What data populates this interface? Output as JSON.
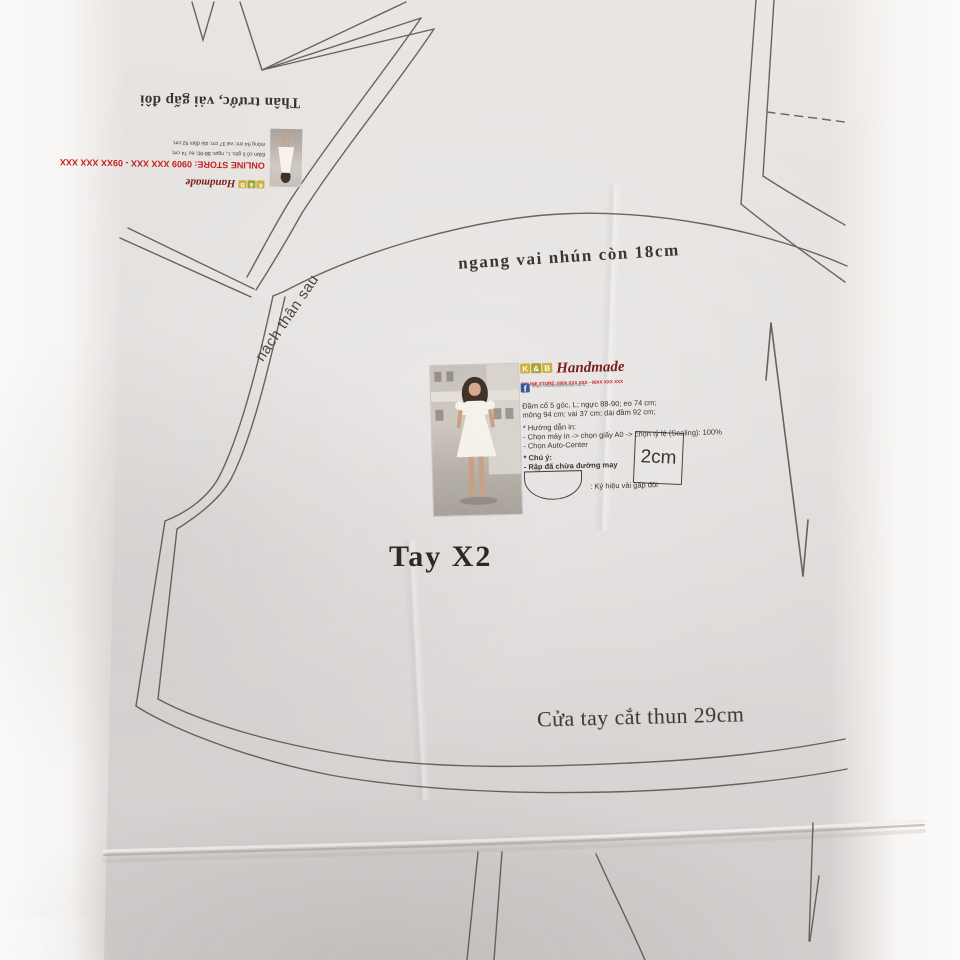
{
  "labels": {
    "shoulder_curve": "ngang vai nhún còn 18cm",
    "back_armhole": "nách thân sau",
    "piece_name": "Tay X2",
    "hem": "Cửa tay cắt thun 29cm",
    "upper_piece": "Thân trước, vải gấp đôi",
    "scale_box": "2cm"
  },
  "info_block": {
    "brand_k": "K",
    "brand_amp": "&",
    "brand_b": "B",
    "brand_name": "Handmade",
    "store_line": "ONLINE STORE: 0909 XXX XXX - 09XX XXX XXX",
    "facebook_f": "f",
    "fb_url": "https://www.facebook.com/…",
    "desc_line1": "Đầm cổ 5 góc, L; ngực 88-90; eo 74 cm;",
    "desc_line2": "mông 94 cm; vai 37 cm; dài đầm 92 cm;",
    "print_title": "* Hướng dẫn in:",
    "print_step1": "- Chọn máy in -> chọn giấy A0 -> chọn tỷ lệ (Scaling): 100%",
    "print_step2": "- Chọn Auto-Center",
    "note_title": "* Chú ý:",
    "note_line": "- Rập đã chừa đường may",
    "fold_symbol_label": ": Ký hiệu vải gấp đôi"
  },
  "colors": {
    "paper": "#e4e1df",
    "line": "#57524a",
    "brand_red": "#7a1d1d",
    "store_red": "#c32222",
    "facebook_blue": "#3a5a98",
    "brand_chip_yellow": "#cdb13e"
  }
}
